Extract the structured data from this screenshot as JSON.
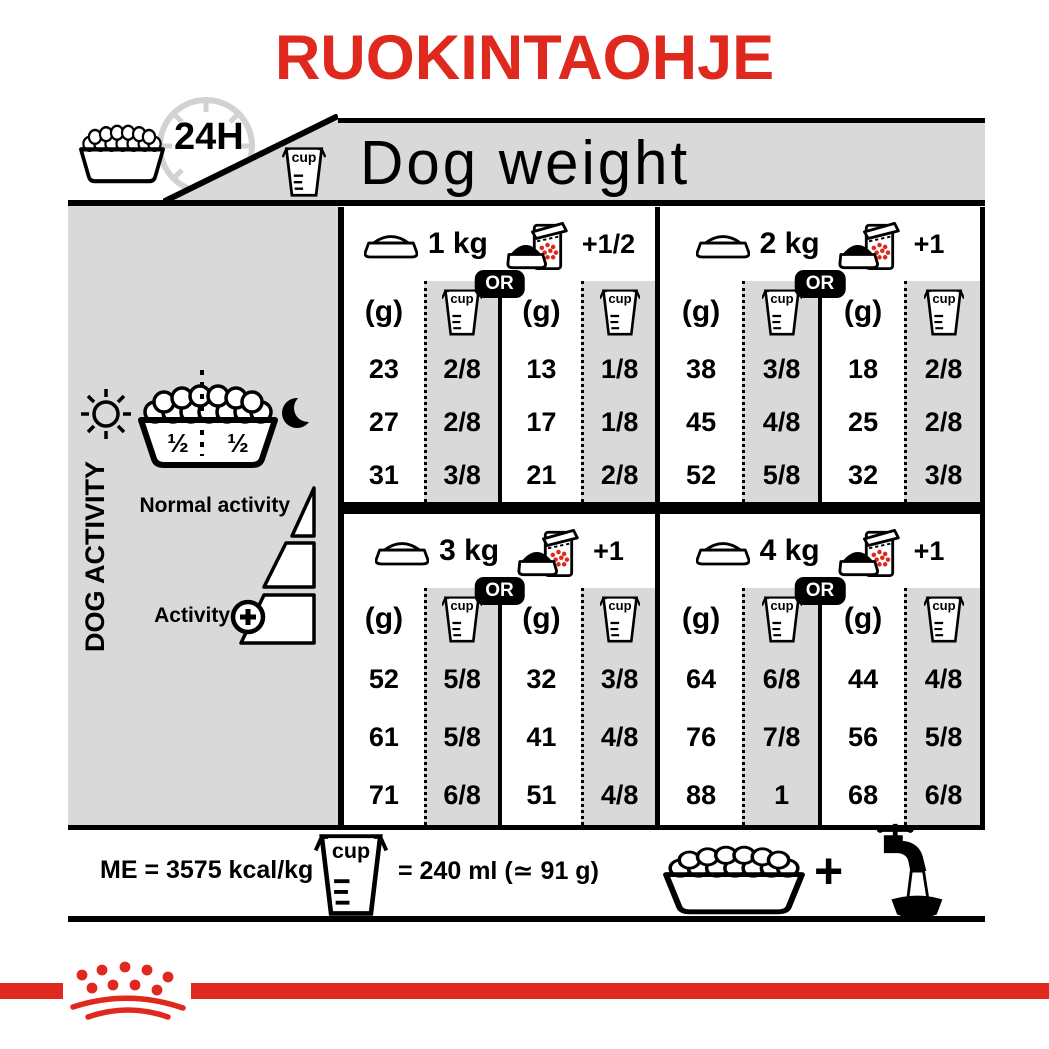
{
  "title": "RUOKINTAOHJE",
  "header": {
    "duration_label": "24H",
    "cup_label": "cup",
    "dog_weight_label": "Dog weight"
  },
  "sidebar": {
    "vertical_label": "DOG ACTIVITY",
    "bowl_half_left": "½",
    "bowl_half_right": "½",
    "normal_activity_label": "Normal activity",
    "activity_label": "Activity",
    "activity_plus": "+"
  },
  "table": {
    "or_label": "OR",
    "grams_label": "(g)",
    "cup_label": "cup",
    "sections": [
      {
        "weight": "1 kg",
        "extra": "+1/2",
        "bowl": {
          "g": [
            "23",
            "27",
            "31"
          ],
          "cup": [
            "2/8",
            "2/8",
            "3/8"
          ]
        },
        "bag": {
          "g": [
            "13",
            "17",
            "21"
          ],
          "cup": [
            "1/8",
            "1/8",
            "2/8"
          ]
        }
      },
      {
        "weight": "2 kg",
        "extra": "+1",
        "bowl": {
          "g": [
            "38",
            "45",
            "52"
          ],
          "cup": [
            "3/8",
            "4/8",
            "5/8"
          ]
        },
        "bag": {
          "g": [
            "18",
            "25",
            "32"
          ],
          "cup": [
            "2/8",
            "2/8",
            "3/8"
          ]
        }
      },
      {
        "weight": "3 kg",
        "extra": "+1",
        "bowl": {
          "g": [
            "52",
            "61",
            "71"
          ],
          "cup": [
            "5/8",
            "5/8",
            "6/8"
          ]
        },
        "bag": {
          "g": [
            "32",
            "41",
            "51"
          ],
          "cup": [
            "3/8",
            "4/8",
            "4/8"
          ]
        }
      },
      {
        "weight": "4 kg",
        "extra": "+1",
        "bowl": {
          "g": [
            "64",
            "76",
            "88"
          ],
          "cup": [
            "6/8",
            "7/8",
            "1"
          ]
        },
        "bag": {
          "g": [
            "44",
            "56",
            "68"
          ],
          "cup": [
            "4/8",
            "5/8",
            "6/8"
          ]
        }
      }
    ]
  },
  "footer": {
    "me_label": "ME = 3575 kcal/kg",
    "cup_label": "cup",
    "cup_equiv_label": "= 240 ml (≃ 91 g)",
    "plus_label": "+"
  },
  "colors": {
    "accent_red": "#e0291e",
    "panel_gray": "#d9d9d9"
  }
}
